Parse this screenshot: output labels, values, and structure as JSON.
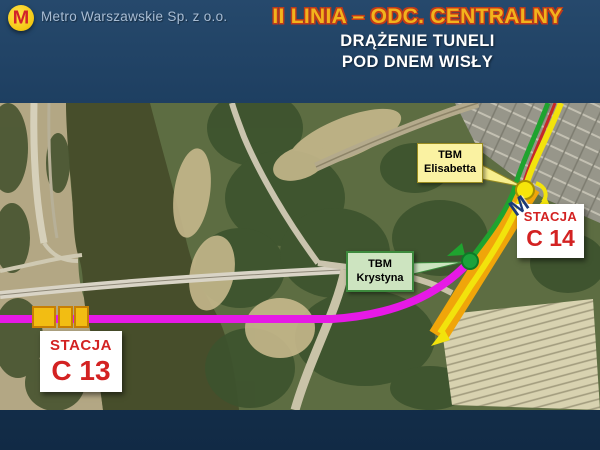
{
  "slide": {
    "header": {
      "logo_letter": "M",
      "company": "Metro Warszawskie Sp. z o.o.",
      "title": "II LINIA – ODC. CENTRALNY",
      "subtitle1": "DRĄŻENIE TUNELI",
      "subtitle2": "POD DNEM WISŁY"
    },
    "colors": {
      "background_navy": "#1d3e60",
      "title_gold": "#f2b31c",
      "title_outline_red": "#bf3a1a",
      "subtitle_white": "#ffffff",
      "company_text": "#a8bdd4",
      "logo_yellow": "#f4c813",
      "logo_red": "#d2232a"
    }
  },
  "map": {
    "stations": [
      {
        "name": "STACJA",
        "code": "C 13",
        "text_color": "#d32222",
        "marker_boxes": 3
      },
      {
        "name": "STACJA",
        "code": "C 14",
        "text_color": "#d32222"
      }
    ],
    "tbms": [
      {
        "line1": "TBM",
        "line2": "Elisabetta",
        "box_fill": "#faf2a2",
        "marker_color": "#f6e50a"
      },
      {
        "line1": "TBM",
        "line2": "Krystyna",
        "box_fill": "#cde4c0",
        "marker_color": "#1ba23c"
      }
    ],
    "station_icon_letter": "M",
    "route_colors": {
      "magenta_planned": "#e619e6",
      "yellow_tbm": "#f2e30c",
      "green_tbm": "#1fa32f",
      "red_alignment": "#c62828",
      "orange_station_zone": "#f0a50a",
      "c13_box_fill": "#f2bd13",
      "c13_box_border": "#c77f04"
    },
    "terrain_colors": {
      "river": "#474e2b",
      "left_bank": "#b3a784",
      "right_bank": "#5d6d42",
      "urban": "#97968a",
      "market_rows": "#d8d2b0"
    }
  }
}
